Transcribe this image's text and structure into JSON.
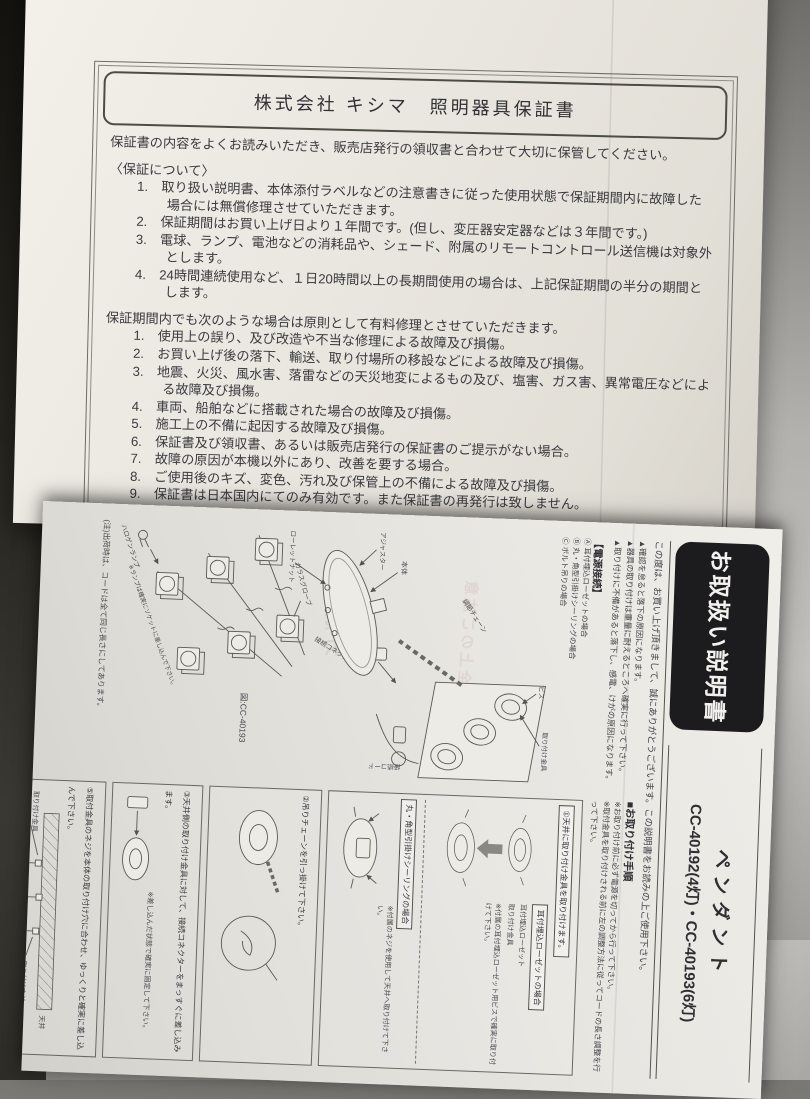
{
  "warranty": {
    "title": "株式会社 キシマ　照明器具保証書",
    "intro": "保証書の内容をよくお読みいただき、販売店発行の領収書と合わせて大切に保管してください。",
    "about_heading": "〈保証について〉",
    "about_items": [
      "1.　取り扱い説明書、本体添付ラベルなどの注意書きに従った使用状態で保証期間内に故障した場合には無償修理させていただきます。",
      "2.　保証期間はお買い上げ日より１年間です。(但し、変圧器安定器などは３年間です。)",
      "3.　電球、ランプ、電池などの消耗品や、シェード、附属のリモートコントロール送信機は対象外とします。",
      "4.　24時間連続使用など、１日20時間以上の長期間使用の場合は、上記保証期間の半分の期間とします。"
    ],
    "paid_heading": "保証期間内でも次のような場合は原則として有料修理とさせていただきます。",
    "paid_items": [
      "1.　使用上の誤り、及び改造や不当な修理による故障及び損傷。",
      "2.　お買い上げ後の落下、輸送、取り付場所の移設などによる故障及び損傷。",
      "3.　地震、火災、風水害、落雷などの天災地変によるもの及び、塩害、ガス害、異常電圧などによる故障及び損傷。",
      "4.　車両、船舶などに搭載された場合の故障及び損傷。",
      "5.　施工上の不備に起因する故障及び損傷。",
      "6.　保証書及び領収書、あるいは販売店発行の保証書のご提示がない場合。",
      "7.　故障の原因が本機以外にあり、改善を要する場合。",
      "8.　ご使用後のキズ、変色、汚れ及び保管上の不備による故障及び損傷。",
      "9.　保証書は日本国内にてのみ有効です。また保証書の再発行は致しません。"
    ],
    "repair_heading": "保証期間中に修理を依頼されるとき",
    "repair_item_partial": "1.　保証期間中に万一、故障が起きた場合は、本書を添えてお買い上げの販売店、工事店まで"
  },
  "manual": {
    "title_box": "お取扱い説明書",
    "product_type": "ペンダント",
    "models": "CC-40192(4灯)・CC-40193(6灯)",
    "greeting": "この度は、お買い上げ頂きまして、誠にありがとうございます。この説明書をお読みの上ご使用下さい。",
    "warnings": [
      "▲確認を怠ると落下の原因になります。",
      "▲器具の取り付けは重量に耐えるところへ確実に行って下さい。",
      "▲取り付けに不備があると落下し、感電、けがの原因になります。"
    ],
    "power_heading": "【電源接続】",
    "power_cases": [
      "Ⓐ 耳付埋込ローゼットの場合",
      "Ⓑ 丸・角型引掛けシーリングの場合",
      "Ⓒ ボルト吊りの場合"
    ],
    "parts": {
      "screw": "ビス",
      "bracket": "取り付け金具",
      "cord": "接続コード",
      "chain": "調節チェーン",
      "connector": "接続コネクター",
      "body": "本体",
      "adjuster": "アジャスター",
      "knurled_nut": "ローレットナット",
      "glass_globe": "ガラスグローブ",
      "halogen_lamp": "ハロゲンランプ",
      "lamp_note": "※ランプは確実にソケットに差し込んで下さい。",
      "figure": "図:CC-40193",
      "ship_note": "(注)出荷時は、コードは全て同じ長さにしてあります。"
    },
    "procedure_heading": "■お取り付け手順",
    "procedure_notes": [
      "※お取り付け前に必ず電源を切ってから行って下さい。",
      "※取付金具を取り付けされる前に左の調整方法に従ってコードの長さ調整を行って下さい。"
    ],
    "steps": {
      "s1": "①天井に取り付け金具を取り付けます。",
      "s1_case_a": "耳付埋込ローゼットの場合",
      "s1_label_rosette": "耳付埋込ローゼット",
      "s1_label_bracket": "取り付け金具",
      "s1_note_a": "※付属の耳付埋込ローゼット用ビスで確実に取り付けて下さい。",
      "s1_case_b": "丸・角型引掛けシーリングの場合",
      "s1_note_b": "※付属のネジを使用して天井へ取り付けて下さい。",
      "s2": "②吊りチェーンを引っ掛けて下さい。",
      "s3": "③天井側の取り付け金具に対して、接続コネクターをまっすぐに差し込みます。",
      "s3_note": "※差し込んだ状態で確実に固定して下さい。",
      "s5": "⑤取付金具のネジを本体の取り付け穴に合わせ、ゆっくりと確実に差し込んで下さい。",
      "s5_labels": {
        "ceiling": "天井",
        "base": "本体ベース",
        "screw": "取り付けネジ",
        "adjuster": "アジャスター",
        "nut": "ローレットナット",
        "bracket": "取り付け金具"
      },
      "s6": "⑥ローレットナットで固定して下さい。",
      "s7": "⑦付属の電球を確実にソケットに差し込んで下さい。(電球には素手で触らないようにして下さい。)"
    },
    "bleed_through": {
      "a": "安全上のご注意",
      "b": "分解禁止"
    }
  }
}
